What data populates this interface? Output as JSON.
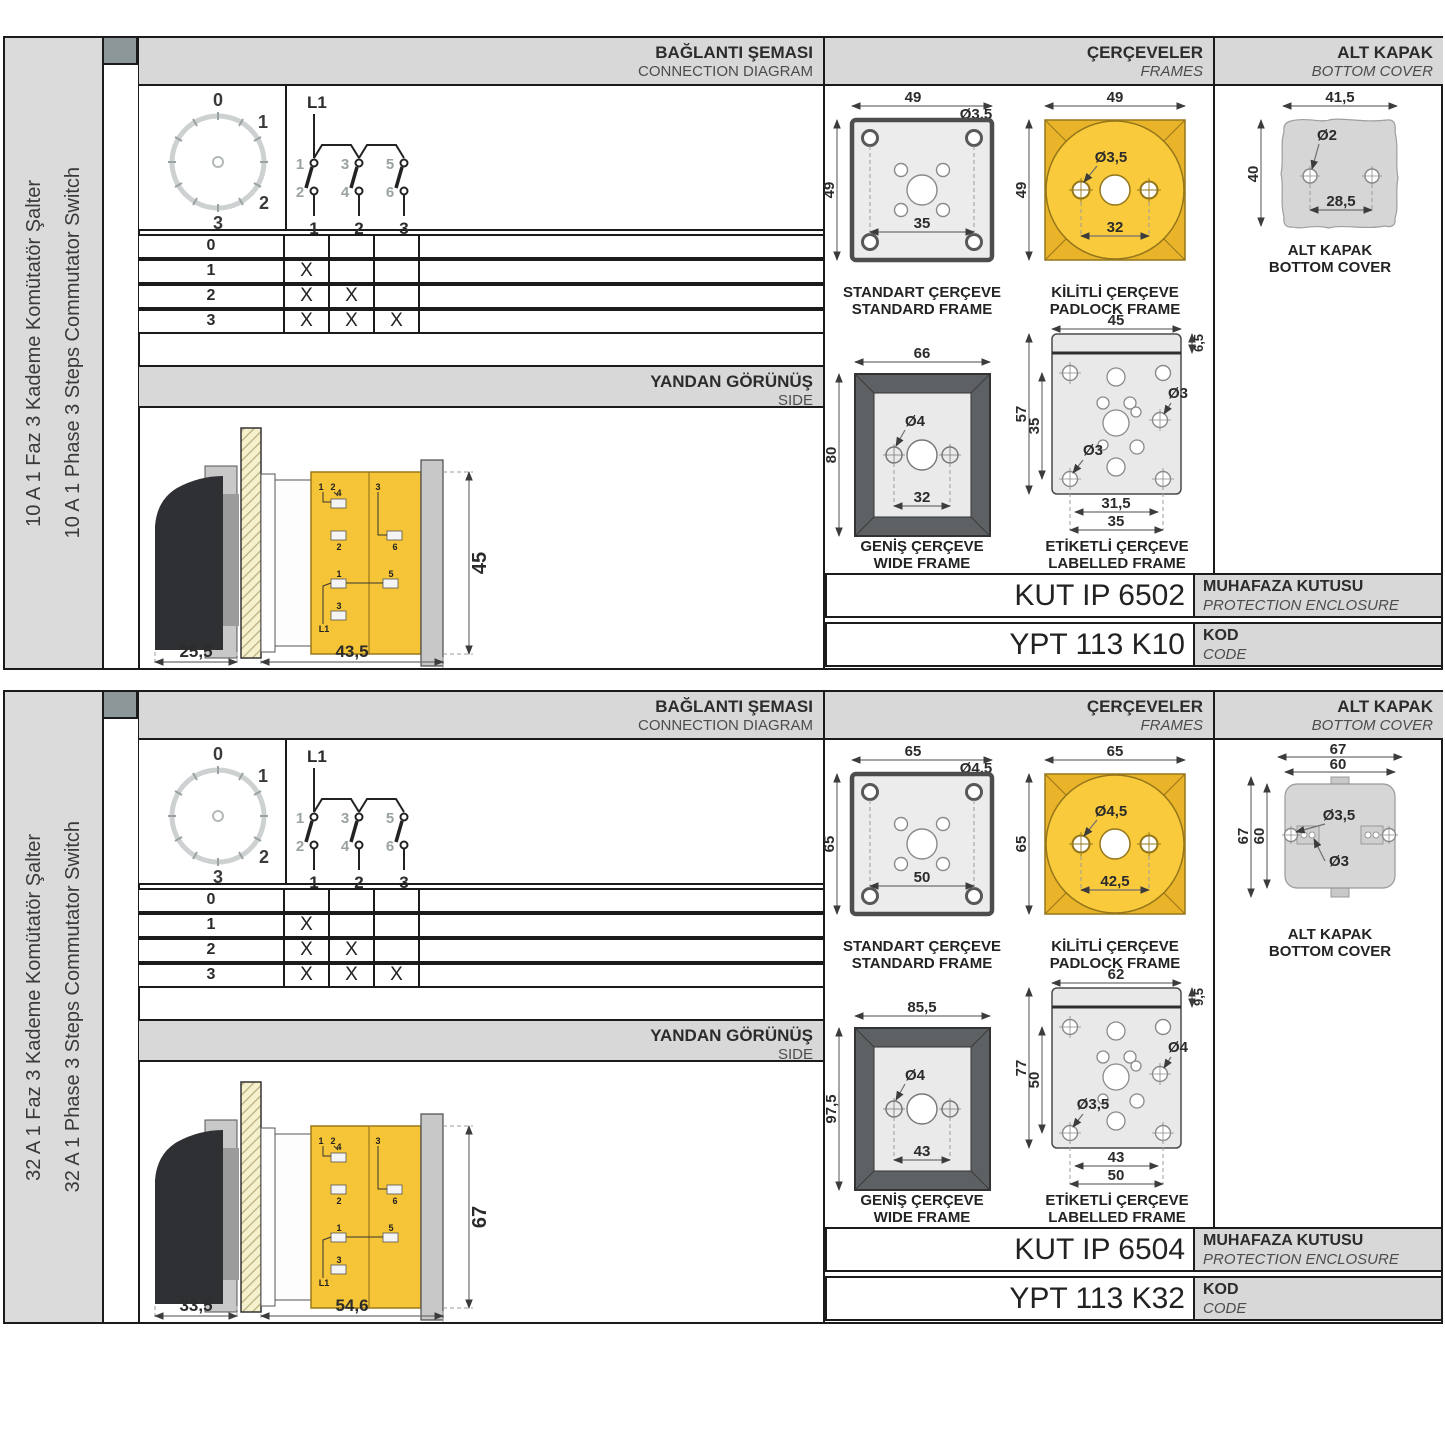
{
  "colors": {
    "accent_yellow": "#f6c437",
    "padlock_yellow": "#f8ca3c",
    "header_gray": "#d8d8d8",
    "frame_dark": "#5d6164"
  },
  "sections": [
    {
      "side_labels": {
        "tr": "10 A 1 Faz 3 Kademe Komütatör Şalter",
        "en": "10 A 1 Phase 3 Steps Commutator Switch"
      },
      "headers": {
        "connection": {
          "tr": "BAĞLANTI ŞEMASI",
          "en": "CONNECTION DIAGRAM"
        },
        "frames": {
          "tr": "ÇERÇEVELER",
          "en": "FRAMES"
        },
        "cover": {
          "tr": "ALT KAPAK",
          "en": "BOTTOM COVER"
        }
      },
      "dial": {
        "positions": [
          "0",
          "1",
          "2",
          "3"
        ]
      },
      "circuit": {
        "line": "L1",
        "top_contacts": [
          "1",
          "3",
          "5"
        ],
        "bottom_contacts": [
          "2",
          "4",
          "6"
        ],
        "outputs": [
          "1",
          "2",
          "3"
        ]
      },
      "truth_table": {
        "rows": [
          {
            "pos": "0",
            "marks": [
              "",
              "",
              ""
            ]
          },
          {
            "pos": "1",
            "marks": [
              "X",
              "",
              ""
            ]
          },
          {
            "pos": "2",
            "marks": [
              "X",
              "X",
              ""
            ]
          },
          {
            "pos": "3",
            "marks": [
              "X",
              "X",
              "X"
            ]
          }
        ]
      },
      "side_view": {
        "header_tr": "YANDAN GÖRÜNÜŞ",
        "header_en": "SIDE",
        "dim_handle": "25,5",
        "dim_body": "43,5",
        "dim_height": "45",
        "terminals": [
          "1",
          "2",
          "4",
          "2",
          "3",
          "6",
          "1",
          "5",
          "3",
          "L1"
        ]
      },
      "frames": {
        "standard": {
          "label_tr": "STANDART ÇERÇEVE",
          "label_en": "STANDARD FRAME",
          "width": "49",
          "height": "49",
          "hole": "Ø3,5",
          "pitch": "35"
        },
        "padlock": {
          "label_tr": "KİLİTLİ ÇERÇEVE",
          "label_en": "PADLOCK FRAME",
          "width": "49",
          "height": "49",
          "hole": "Ø3,5",
          "pitch": "32"
        },
        "wide": {
          "label_tr": "GENİŞ ÇERÇEVE",
          "label_en": "WIDE FRAME",
          "width": "66",
          "height": "80",
          "hole": "Ø4",
          "pitch": "32"
        },
        "labelled": {
          "label_tr": "ETİKETLİ ÇERÇEVE",
          "label_en": "LABELLED FRAME",
          "width": "45",
          "strip": "6,5",
          "height": "57",
          "pitch_v": "35",
          "hole_top": "Ø3",
          "hole_bottom": "Ø3",
          "pitch_b1": "31,5",
          "pitch_b2": "35"
        }
      },
      "cover": {
        "label_tr": "ALT KAPAK",
        "label_en": "BOTTOM COVER",
        "width": "41,5",
        "height": "40",
        "hole": "Ø2",
        "pitch": "28,5"
      },
      "codes": {
        "enclosure_code": "KUT IP 6502",
        "enclosure_tr": "MUHAFAZA KUTUSU",
        "enclosure_en": "PROTECTION ENCLOSURE",
        "product_code": "YPT 113 K10",
        "code_tr": "KOD",
        "code_en": "CODE"
      }
    },
    {
      "side_labels": {
        "tr": "32 A 1 Faz 3 Kademe Komütatör Şalter",
        "en": "32 A 1 Phase 3 Steps Commutator Switch"
      },
      "headers": {
        "connection": {
          "tr": "BAĞLANTI ŞEMASI",
          "en": "CONNECTION DIAGRAM"
        },
        "frames": {
          "tr": "ÇERÇEVELER",
          "en": "FRAMES"
        },
        "cover": {
          "tr": "ALT KAPAK",
          "en": "BOTTOM COVER"
        }
      },
      "dial": {
        "positions": [
          "0",
          "1",
          "2",
          "3"
        ]
      },
      "circuit": {
        "line": "L1",
        "top_contacts": [
          "1",
          "3",
          "5"
        ],
        "bottom_contacts": [
          "2",
          "4",
          "6"
        ],
        "outputs": [
          "1",
          "2",
          "3"
        ]
      },
      "truth_table": {
        "rows": [
          {
            "pos": "0",
            "marks": [
              "",
              "",
              ""
            ]
          },
          {
            "pos": "1",
            "marks": [
              "X",
              "",
              ""
            ]
          },
          {
            "pos": "2",
            "marks": [
              "X",
              "X",
              ""
            ]
          },
          {
            "pos": "3",
            "marks": [
              "X",
              "X",
              "X"
            ]
          }
        ]
      },
      "side_view": {
        "header_tr": "YANDAN GÖRÜNÜŞ",
        "header_en": "SIDE",
        "dim_handle": "33,5",
        "dim_body": "54,6",
        "dim_height": "67",
        "terminals": [
          "1",
          "2",
          "4",
          "2",
          "3",
          "6",
          "1",
          "5",
          "3",
          "L1"
        ]
      },
      "frames": {
        "standard": {
          "label_tr": "STANDART ÇERÇEVE",
          "label_en": "STANDARD FRAME",
          "width": "65",
          "height": "65",
          "hole": "Ø4,5",
          "pitch": "50"
        },
        "padlock": {
          "label_tr": "KİLİTLİ ÇERÇEVE",
          "label_en": "PADLOCK FRAME",
          "width": "65",
          "height": "65",
          "hole": "Ø4,5",
          "pitch": "42,5"
        },
        "wide": {
          "label_tr": "GENİŞ ÇERÇEVE",
          "label_en": "WIDE FRAME",
          "width": "85,5",
          "height": "97,5",
          "hole": "Ø4",
          "pitch": "43"
        },
        "labelled": {
          "label_tr": "ETİKETLİ ÇERÇEVE",
          "label_en": "LABELLED FRAME",
          "width": "62",
          "strip": "9,5",
          "height": "77",
          "pitch_v": "50",
          "hole_top": "Ø4",
          "hole_bottom": "Ø3,5",
          "pitch_b1": "43",
          "pitch_b2": "50"
        }
      },
      "cover": {
        "label_tr": "ALT KAPAK",
        "label_en": "BOTTOM COVER",
        "width_outer": "67",
        "width_inner": "60",
        "height_outer": "67",
        "height_inner": "60",
        "hole_big": "Ø3,5",
        "hole_small": "Ø3"
      },
      "codes": {
        "enclosure_code": "KUT IP 6504",
        "enclosure_tr": "MUHAFAZA KUTUSU",
        "enclosure_en": "PROTECTION ENCLOSURE",
        "product_code": "YPT 113 K32",
        "code_tr": "KOD",
        "code_en": "CODE"
      }
    }
  ]
}
